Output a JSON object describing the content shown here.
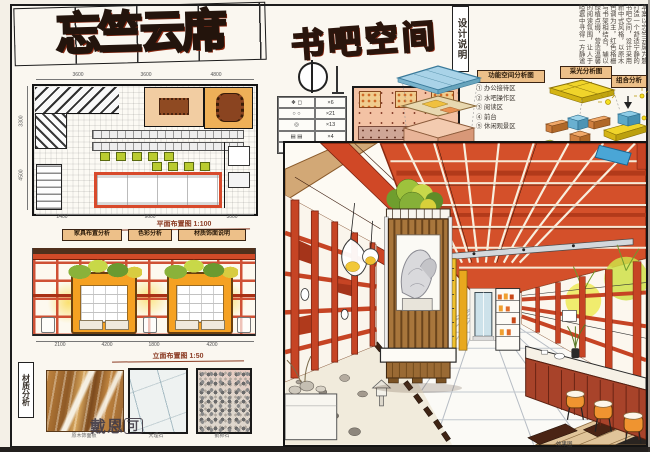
{
  "colors": {
    "accent_red": "#d4502a",
    "title_red": "#e5512d",
    "booth_orange": "#f5a122",
    "plant_green": "#8ab23a",
    "glass_blue": "#a9d3e8",
    "paper": "#faf7f0"
  },
  "header": {
    "title": "忘竺云席",
    "subtitle": "书吧空间",
    "note_label": "设计说明",
    "note_columns": [
      "本案以忘竺云席为题",
      "打造一个舒适宁静的",
      "书吧空间，设计采用",
      "新中式风格，以原木",
      "色调为主，红色格栅",
      "与书架相结合，辅以",
      "绿植点缀，营造温馨",
      "的阅读氛围，让人于",
      "喧嚣中寻得一方静谧"
    ]
  },
  "analysis": {
    "function_label": "功能空间分析图",
    "daylight_label": "采光分析图",
    "combine_label": "组合分析",
    "items": [
      "① 办公接待区",
      "② 水吧操作区",
      "③ 阅读区",
      "④ 前台",
      "⑤ 休闲观景区"
    ]
  },
  "legend": {
    "rows": [
      {
        "sym": "❖ ◻",
        "qty": "×6"
      },
      {
        "sym": "○ ○",
        "qty": "×21"
      },
      {
        "sym": "◎",
        "qty": "×13"
      },
      {
        "sym": "▤ ▤",
        "qty": "×4"
      },
      {
        "sym": "◌◌◌",
        "qty": "×8"
      }
    ]
  },
  "mini_plan": {
    "dims": [
      "2400",
      "5400",
      "2400"
    ]
  },
  "plan": {
    "caption": "平面布置图 1:100",
    "dims_top": [
      "3600",
      "3600",
      "4800"
    ],
    "dims_left": [
      "3300",
      "4500"
    ],
    "dims_bottom": [
      "2400",
      "9600",
      "3000"
    ],
    "tags": [
      "家具布置分析",
      "色彩分析",
      "材质饰面说明"
    ]
  },
  "elevation": {
    "caption": "立面布置图 1:50",
    "dims": [
      "2100",
      "4200",
      "1800",
      "4200"
    ]
  },
  "materials": {
    "label": "材质分析",
    "swatches": [
      {
        "name": "原木饰面板"
      },
      {
        "name": "大理石"
      },
      {
        "name": "鹅卵石"
      }
    ]
  },
  "watermark": {
    "left": "戴恩",
    "boxed": "可"
  },
  "footer_caption": "效果图"
}
